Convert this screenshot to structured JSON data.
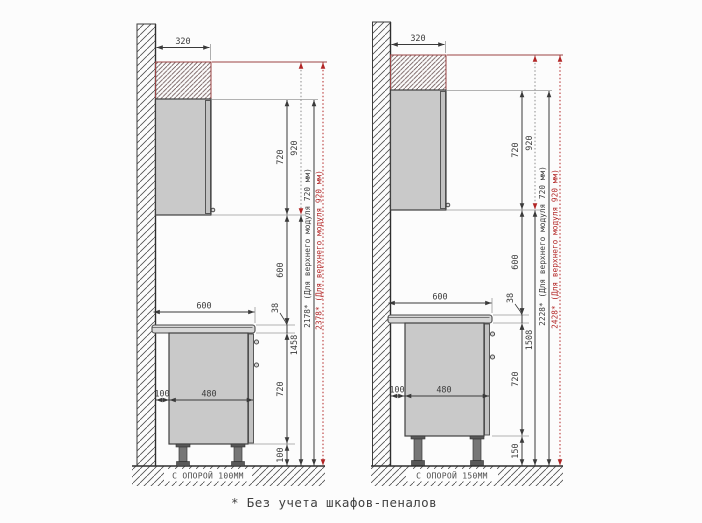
{
  "colors": {
    "dimension_red": "#b22525",
    "cabinet_gray": "#c9c9c9",
    "extension_maroon": "#9b4545"
  },
  "footnote": "* Без учета шкафов-пеналов",
  "left": {
    "upper_cabinet_width": "320",
    "upper_cabinet_height": "720",
    "upper_cabinet_height_alt": "920",
    "backsplash_gap": "600",
    "countertop_thickness": "38",
    "upper_cabinet_bottom_height": "1458",
    "total_height_720": "2178* (Для верхнего модуля 720 мм)",
    "total_height_920": "2378* (Для верхнего модуля 920 мм)",
    "countertop_depth": "600",
    "wall_offset": "100",
    "base_cabinet_depth": "480",
    "base_cabinet_height": "720",
    "leg_height": "100",
    "support_label": "С ОПОРОЙ 100ММ"
  },
  "right": {
    "upper_cabinet_width": "320",
    "upper_cabinet_height": "720",
    "upper_cabinet_height_alt": "920",
    "backsplash_gap": "600",
    "countertop_thickness": "38",
    "upper_cabinet_bottom_height": "1508",
    "total_height_720": "2228* (Для верхнего модуля 720 мм)",
    "total_height_920": "2428* (Для верхнего модуля 920 мм)",
    "countertop_depth": "600",
    "wall_offset": "100",
    "base_cabinet_depth": "480",
    "base_cabinet_height": "720",
    "leg_height": "150",
    "support_label": "С ОПОРОЙ 150ММ"
  }
}
